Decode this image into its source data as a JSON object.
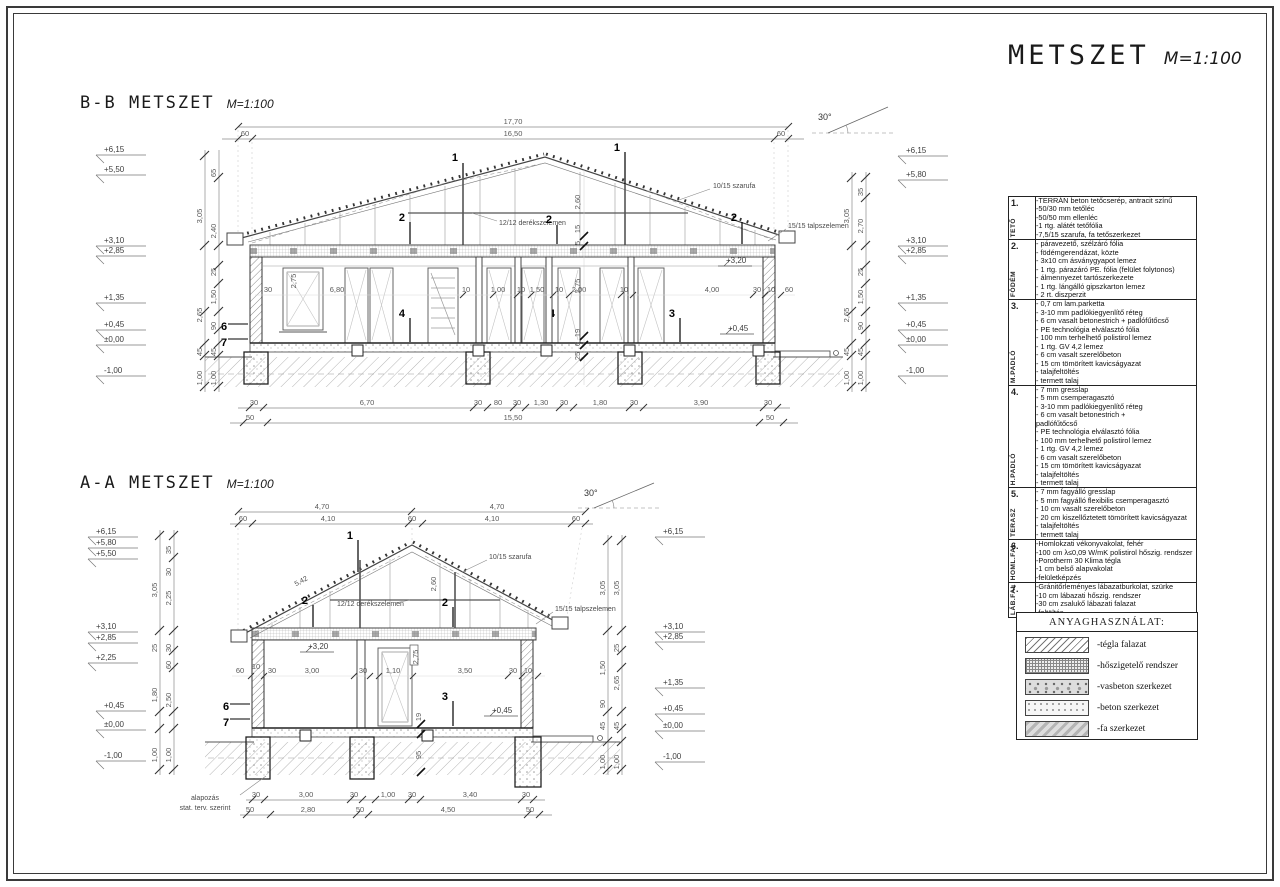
{
  "sheet": {
    "title": "METSZET",
    "scale": "M=1:100"
  },
  "markers": [
    "1",
    "2",
    "3",
    "4",
    "6",
    "7"
  ],
  "bb": {
    "title": "B-B METSZET",
    "scale": "M=1:100",
    "slope": "30°",
    "dims_top": [
      "17,70",
      "60",
      "16,50",
      "60"
    ],
    "levels_left": [
      "+6,15",
      "+5,50",
      "+3,10",
      "+2,85",
      "+1,35",
      "+0,45",
      "±0,00",
      "-1,00"
    ],
    "chain_left": [
      "65",
      "3,05",
      "2,40",
      "25",
      "2,65",
      "1,50",
      "90",
      "45",
      "45",
      "1,00",
      "1,00"
    ],
    "levels_right": [
      "+6,15",
      "+5,80",
      "+3,10",
      "+2,85",
      "+1,35",
      "+0,45",
      "±0,00",
      "-1,00"
    ],
    "chain_right": [
      "35",
      "3,05",
      "2,70",
      "25",
      "2,65",
      "1,50",
      "90",
      "45",
      "45",
      "1,00",
      "1,00"
    ],
    "labels": {
      "rafter": "10/15 szarufa",
      "collar": "12/12 derékszelemen",
      "plate": "15/15 talpszelemen"
    },
    "level_marks": [
      "+3,20",
      "+0,45"
    ],
    "dims_mid": [
      "30",
      "2,75",
      "6,80",
      "10",
      "1,00",
      "10",
      "1,50",
      "10",
      "2,00",
      "10",
      "4,00",
      "30",
      "10",
      "60"
    ],
    "dims_vert": [
      "2,60",
      "15",
      "5",
      "2,75",
      "19",
      "6",
      "25"
    ],
    "dims_bottom": [
      "30",
      "6,70",
      "30",
      "80",
      "30",
      "1,30",
      "30",
      "1,80",
      "30",
      "3,90",
      "30"
    ],
    "dims_found": [
      "50",
      "15,50",
      "50"
    ]
  },
  "aa": {
    "title": "A-A METSZET",
    "scale": "M=1:100",
    "slope": "30°",
    "rafter_len": "5,42",
    "dims_top1": [
      "4,70",
      "4,70"
    ],
    "dims_top2": [
      "60",
      "4,10",
      "60",
      "4,10",
      "60"
    ],
    "levels_left": [
      "+6,15",
      "+5,80",
      "+5,50",
      "+3,10",
      "+2,85",
      "+2,25",
      "+0,45",
      "±0,00",
      "-1,00"
    ],
    "chain_left": [
      "35",
      "30",
      "3,05",
      "2,25",
      "25",
      "30",
      "60",
      "1,80",
      "2,50",
      "1,00",
      "1,00"
    ],
    "levels_right": [
      "+6,15",
      "+3,10",
      "+2,85",
      "+1,35",
      "+0,45",
      "±0,00",
      "-1,00"
    ],
    "chain_right": [
      "3,05",
      "3,05",
      "25",
      "1,50",
      "2,65",
      "90",
      "45",
      "45",
      "1,00",
      "1,00"
    ],
    "labels": {
      "rafter": "10/15 szarufa",
      "collar": "12/12 derékszelemen",
      "plate": "15/15 talpszelemen"
    },
    "level_marks": [
      "+3,20",
      "+0,45"
    ],
    "dims_mid": [
      "60",
      "10",
      "30",
      "3,00",
      "30",
      "1,10",
      "3,50",
      "30",
      "10"
    ],
    "dims_vert": [
      "2,60",
      "2,75",
      "19",
      "95"
    ],
    "dims_bottom": [
      "30",
      "3,00",
      "30",
      "1,00",
      "30",
      "3,40",
      "30"
    ],
    "dims_found": [
      "50",
      "2,80",
      "50",
      "4,50",
      "50"
    ],
    "note_line1": "alapozás",
    "note_line2": "stat. terv. szerint"
  },
  "notes": {
    "items": [
      {
        "num": "1.",
        "cat": "TETŐ",
        "lines": [
          "-TERRÁN beton tetőcserép, antracit színű",
          "-50/30 mm tetőléc",
          "-50/50 mm ellenléc",
          "-1 rtg. alátét tetőfólia",
          "-7,5/15 szarufa, fa tetőszerkezet"
        ]
      },
      {
        "num": "2.",
        "cat": "FÖDÉM",
        "lines": [
          "- páravezető, szélzáró fólia",
          "- födémgerendázat, közte",
          "- 3x10 cm ásványgyapot lemez",
          "- 1 rtg. párazáró PE. fólia (felület folytonos)",
          "- álmennyezet tartószerkezete",
          "- 1 rtg. lángálló gipszkarton lemez",
          "- 2 rt. diszperzit"
        ]
      },
      {
        "num": "3.",
        "cat": "M.PADLÓ",
        "lines": [
          "- 0,7 cm lam.parketta",
          "- 3-10 mm padlókiegyenlítő réteg",
          "- 6 cm vasalt betonestrich + padlófűtőcső",
          "- PE technológia elválasztó fólia",
          "- 100 mm terhelhető polistirol lemez",
          "- 1 rtg. GV 4,2 lemez",
          "- 6 cm vasalt szerelőbeton",
          "- 15 cm tömörített kavicságyazat",
          "- talajfeltöltés",
          "- termett talaj"
        ]
      },
      {
        "num": "4.",
        "cat": "H.PADLÓ",
        "lines": [
          "- 7 mm gresslap",
          "- 5 mm csemperagasztó",
          "- 3-10 mm padlókiegyenlítő réteg",
          "- 6 cm vasalt betonestrich +",
          "  padlófűtőcső",
          "- PE technológia elválasztó fólia",
          "- 100 mm terhelhető polistirol lemez",
          "- 1 rtg. GV 4,2 lemez",
          "- 6 cm vasalt szerelőbeton",
          "- 15 cm tömörített kavicságyazat",
          "- talajfeltöltés",
          "- termett talaj"
        ]
      },
      {
        "num": "5.",
        "cat": "TERASZ",
        "lines": [
          "- 7 mm fagyálló gresslap",
          "- 5 mm fagyálló flexibilis csemperagasztó",
          "- 10 cm vasalt szerelőbeton",
          "- 20 cm kiszellőztetett tömörített kavicságyazat",
          "- talajfeltöltés",
          "- termett talaj"
        ]
      },
      {
        "num": "6.",
        "cat": "HOML.FAL",
        "lines": [
          "-Homlokzati vékonyvakolat, fehér",
          "-100 cm λ≤0,09 W/mK polistirol hőszig. rendszer",
          "-Porotherm 30 Klima tégla",
          "-1 cm belső alapvakolat",
          "-felületképzés"
        ]
      },
      {
        "num": "7.",
        "cat": "LÁB.FAL",
        "lines": [
          "-Gránitőrleményes lábazatburkolat, szürke",
          "-10 cm lábazati hőszig. rendszer",
          "-30 cm zsalukő lábazati falazat",
          "-feltöltés"
        ]
      }
    ]
  },
  "legend": {
    "title": "ANYAGHASZNÁLAT:",
    "items": [
      {
        "label": "-tégla falazat"
      },
      {
        "label": "-hőszigetelő rendszer"
      },
      {
        "label": "-vasbeton szerkezet"
      },
      {
        "label": "-beton szerkezet"
      },
      {
        "label": "-fa szerkezet"
      }
    ]
  }
}
